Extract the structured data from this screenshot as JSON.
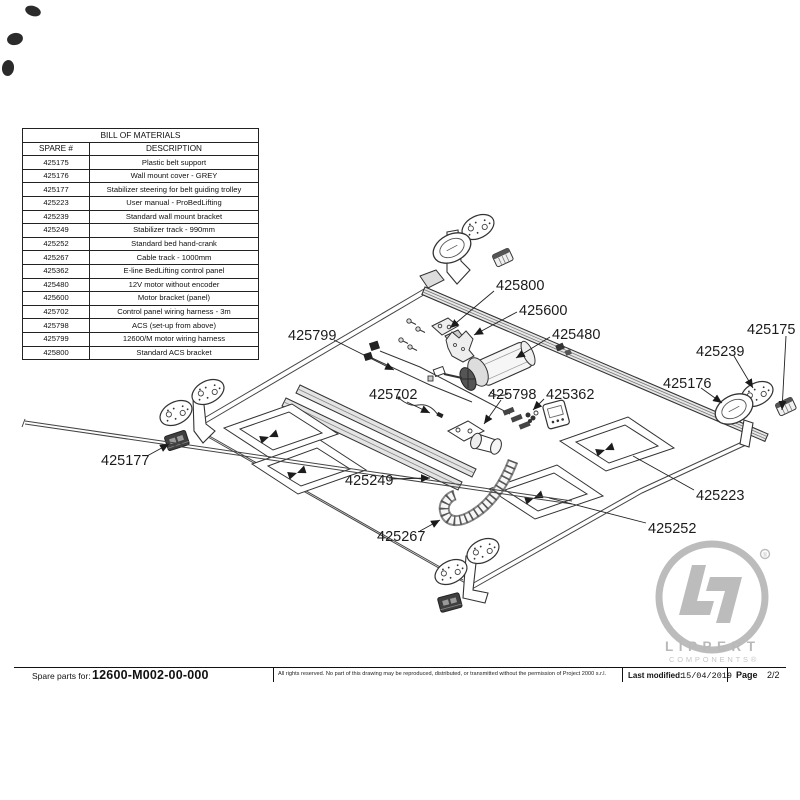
{
  "bom": {
    "title": "BILL OF MATERIALS",
    "columns": [
      "SPARE #",
      "DESCRIPTION"
    ],
    "rows": [
      {
        "spare": "425175",
        "description": "Plastic belt support"
      },
      {
        "spare": "425176",
        "description": "Wall mount cover - GREY"
      },
      {
        "spare": "425177",
        "description": "Stabilizer steering for belt guiding trolley"
      },
      {
        "spare": "425223",
        "description": "User manual - ProBedLifting"
      },
      {
        "spare": "425239",
        "description": "Standard wall mount bracket"
      },
      {
        "spare": "425249",
        "description": "Stabilizer track - 990mm"
      },
      {
        "spare": "425252",
        "description": "Standard bed hand-crank"
      },
      {
        "spare": "425267",
        "description": "Cable track - 1000mm"
      },
      {
        "spare": "425362",
        "description": "E-line BedLifting control panel"
      },
      {
        "spare": "425480",
        "description": "12V motor without encoder"
      },
      {
        "spare": "425600",
        "description": "Motor bracket (panel)"
      },
      {
        "spare": "425702",
        "description": "Control panel wiring harness - 3m"
      },
      {
        "spare": "425798",
        "description": "ACS (set-up from above)"
      },
      {
        "spare": "425799",
        "description": "12600/M motor wiring harness"
      },
      {
        "spare": "425800",
        "description": "Standard ACS bracket"
      }
    ]
  },
  "diagram": {
    "labels": [
      {
        "text": "425800"
      },
      {
        "text": "425600"
      },
      {
        "text": "425480"
      },
      {
        "text": "425799"
      },
      {
        "text": "425702"
      },
      {
        "text": "425798"
      },
      {
        "text": "425362"
      },
      {
        "text": "425175"
      },
      {
        "text": "425239"
      },
      {
        "text": "425176"
      },
      {
        "text": "425177"
      },
      {
        "text": "425249"
      },
      {
        "text": "425267"
      },
      {
        "text": "425223"
      },
      {
        "text": "425252"
      }
    ]
  },
  "footer": {
    "spare_parts_label": "Spare parts for:",
    "part_number": "12600-M002-00-000",
    "copyright": "All rights reserved. No part of this drawing may be reproduced, distributed, or transmitted without the permission of Project 2000 s.r.l.",
    "last_modified_label": "Last modified:",
    "last_modified_date": "15/04/2019",
    "page_label": "Page",
    "page_value": "2/2"
  },
  "logo": {
    "brand_line1": "LIPPERT",
    "brand_line2": "COMPONENTS®",
    "registered": "®",
    "gray": "#b9b9b9"
  }
}
